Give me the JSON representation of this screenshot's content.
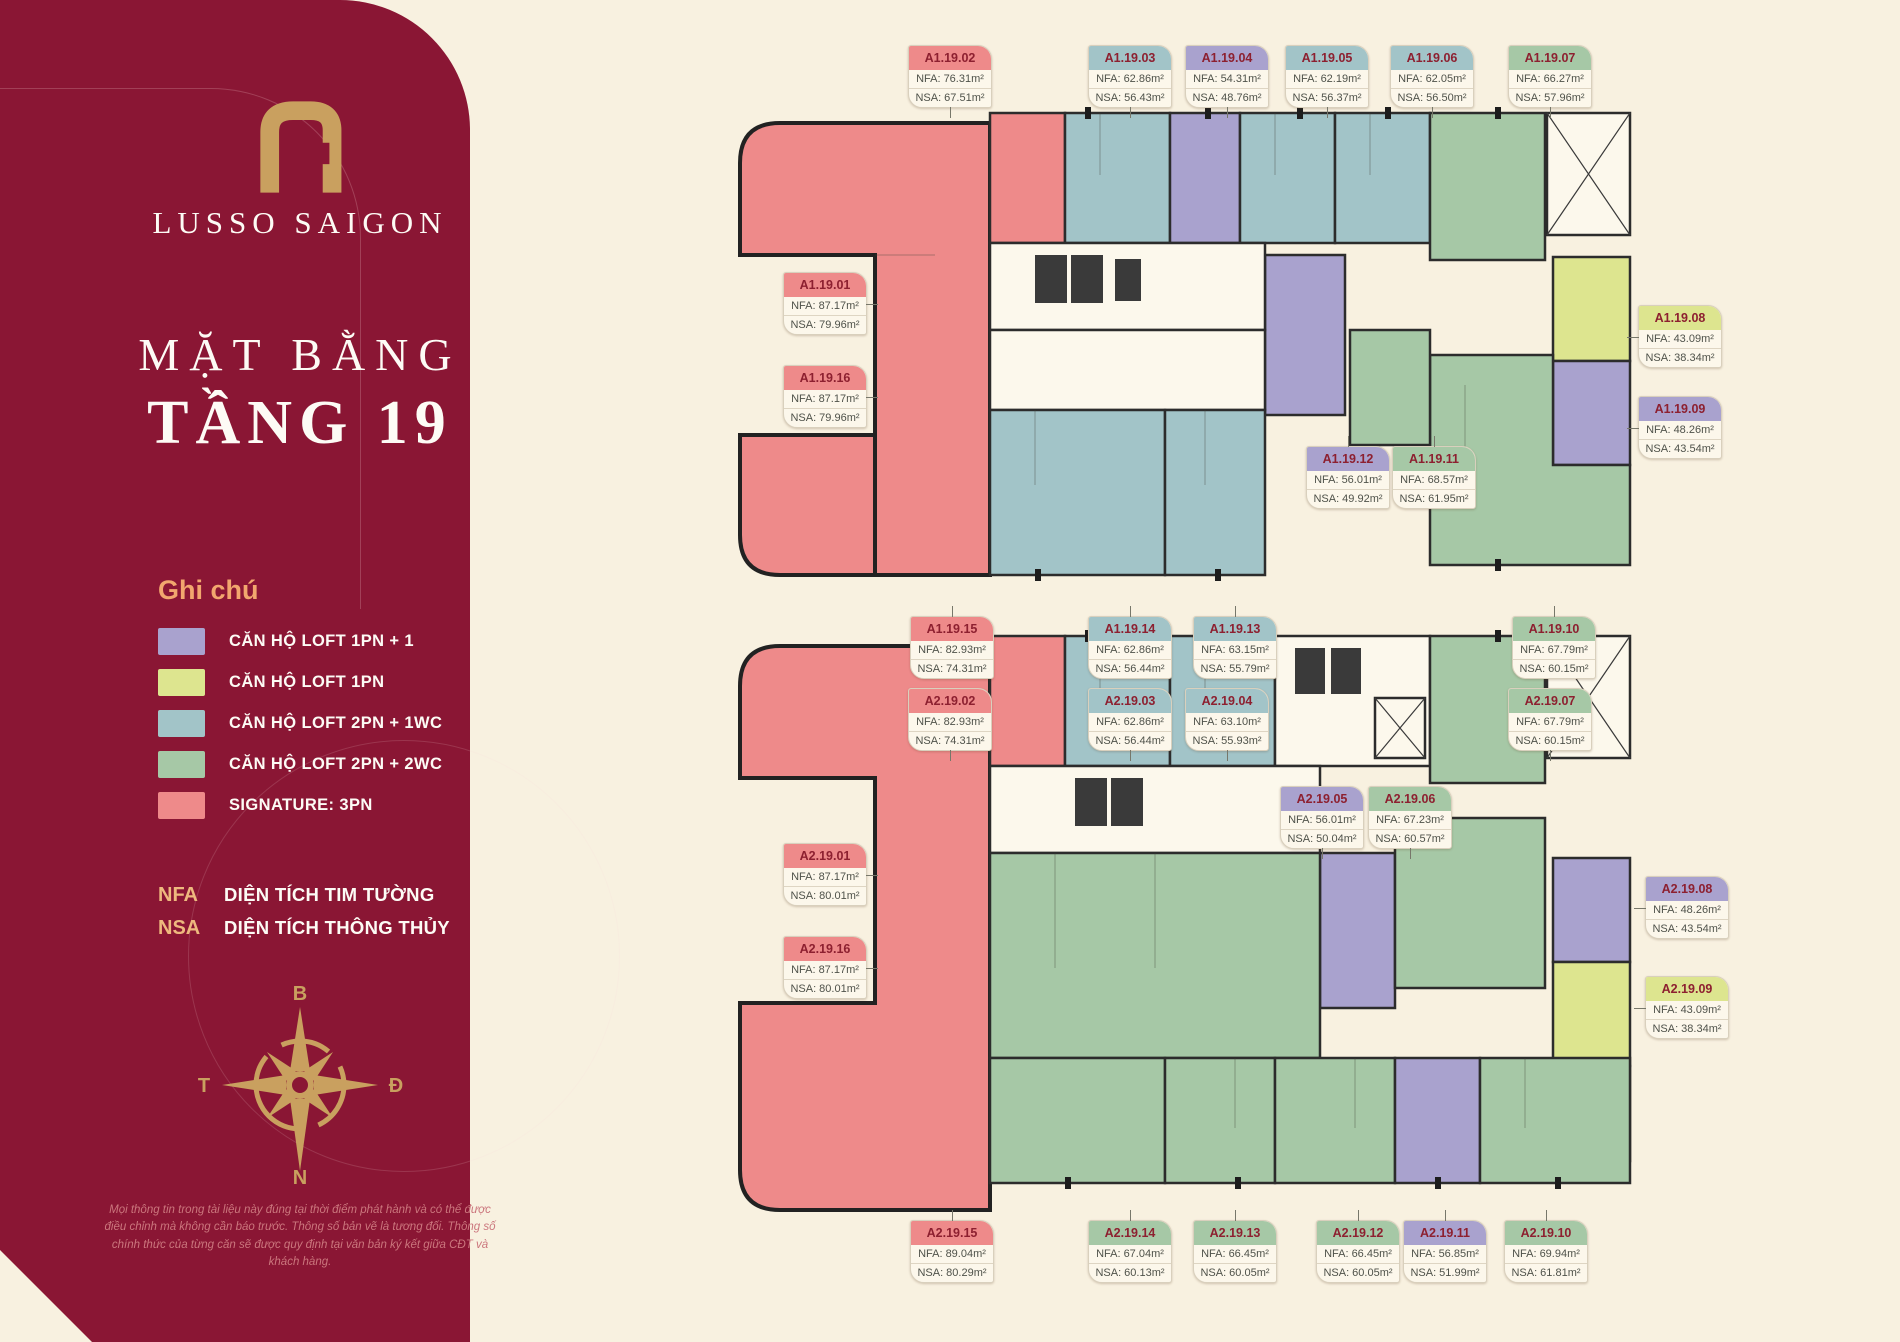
{
  "sidebar": {
    "brand": "LUSSO SAIGON",
    "title_line1": "MẶT BẰNG",
    "title_line2": "TẦNG 19",
    "legend_title": "Ghi chú",
    "legend": [
      {
        "label": "CĂN HỘ LOFT 1PN + 1",
        "color": "#a9a2ce"
      },
      {
        "label": "CĂN HỘ LOFT 1PN",
        "color": "#dde58f"
      },
      {
        "label": "CĂN HỘ LOFT 2PN + 1WC",
        "color": "#a2c4c8"
      },
      {
        "label": "CĂN HỘ LOFT 2PN + 2WC",
        "color": "#a6c8a6"
      },
      {
        "label": "SIGNATURE: 3PN",
        "color": "#ee8a8a"
      }
    ],
    "abbreviations": [
      {
        "key": "NFA",
        "label": "DIỆN TÍCH TIM TƯỜNG"
      },
      {
        "key": "NSA",
        "label": "DIỆN TÍCH THÔNG THỦY"
      }
    ],
    "compass": {
      "north": "B",
      "south": "N",
      "west": "T",
      "east": "Đ"
    },
    "disclaimer": "Mọi thông tin trong tài liệu này đúng tại thời điểm phát hành và có thể được điều chỉnh mà không cần báo trước. Thông số bản vẽ là tương đối. Thông số chính thức của từng căn sẽ được quy định tại văn bản ký kết giữa CĐT và khách hàng."
  },
  "card_keys": {
    "nfa_prefix": "NFA:",
    "nsa_prefix": "NSA:"
  },
  "colors": {
    "background": "#f8f1e0",
    "panel": "#8a1634",
    "gold": "#c9a05f",
    "legend_title": "#f2a76e",
    "card_header_text": "#8d2030",
    "signature": "#ee8a8a",
    "loft_1pn_1": "#a9a2ce",
    "loft_1pn": "#dde58f",
    "loft_2pn_1wc": "#a2c4c8",
    "loft_2pn_2wc": "#a6c8a6"
  },
  "units": [
    {
      "id": "A1.19.01",
      "nfa": "87.17m²",
      "nsa": "79.96m²",
      "type": "signature"
    },
    {
      "id": "A1.19.02",
      "nfa": "76.31m²",
      "nsa": "67.51m²",
      "type": "signature"
    },
    {
      "id": "A1.19.03",
      "nfa": "62.86m²",
      "nsa": "56.43m²",
      "type": "loft_2pn_1wc"
    },
    {
      "id": "A1.19.04",
      "nfa": "54.31m²",
      "nsa": "48.76m²",
      "type": "loft_1pn_1"
    },
    {
      "id": "A1.19.05",
      "nfa": "62.19m²",
      "nsa": "56.37m²",
      "type": "loft_2pn_1wc"
    },
    {
      "id": "A1.19.06",
      "nfa": "62.05m²",
      "nsa": "56.50m²",
      "type": "loft_2pn_1wc"
    },
    {
      "id": "A1.19.07",
      "nfa": "66.27m²",
      "nsa": "57.96m²",
      "type": "loft_2pn_2wc"
    },
    {
      "id": "A1.19.08",
      "nfa": "43.09m²",
      "nsa": "38.34m²",
      "type": "loft_1pn"
    },
    {
      "id": "A1.19.09",
      "nfa": "48.26m²",
      "nsa": "43.54m²",
      "type": "loft_1pn_1"
    },
    {
      "id": "A1.19.10",
      "nfa": "67.79m²",
      "nsa": "60.15m²",
      "type": "loft_2pn_2wc"
    },
    {
      "id": "A1.19.11",
      "nfa": "68.57m²",
      "nsa": "61.95m²",
      "type": "loft_2pn_2wc"
    },
    {
      "id": "A1.19.12",
      "nfa": "56.01m²",
      "nsa": "49.92m²",
      "type": "loft_1pn_1"
    },
    {
      "id": "A1.19.13",
      "nfa": "63.15m²",
      "nsa": "55.79m²",
      "type": "loft_2pn_1wc"
    },
    {
      "id": "A1.19.14",
      "nfa": "62.86m²",
      "nsa": "56.44m²",
      "type": "loft_2pn_1wc"
    },
    {
      "id": "A1.19.15",
      "nfa": "82.93m²",
      "nsa": "74.31m²",
      "type": "signature"
    },
    {
      "id": "A1.19.16",
      "nfa": "87.17m²",
      "nsa": "79.96m²",
      "type": "signature"
    },
    {
      "id": "A2.19.01",
      "nfa": "87.17m²",
      "nsa": "80.01m²",
      "type": "signature"
    },
    {
      "id": "A2.19.02",
      "nfa": "82.93m²",
      "nsa": "74.31m²",
      "type": "signature"
    },
    {
      "id": "A2.19.03",
      "nfa": "62.86m²",
      "nsa": "56.44m²",
      "type": "loft_2pn_1wc"
    },
    {
      "id": "A2.19.04",
      "nfa": "63.10m²",
      "nsa": "55.93m²",
      "type": "loft_2pn_1wc"
    },
    {
      "id": "A2.19.05",
      "nfa": "56.01m²",
      "nsa": "50.04m²",
      "type": "loft_1pn_1"
    },
    {
      "id": "A2.19.06",
      "nfa": "67.23m²",
      "nsa": "60.57m²",
      "type": "loft_2pn_2wc"
    },
    {
      "id": "A2.19.07",
      "nfa": "67.79m²",
      "nsa": "60.15m²",
      "type": "loft_2pn_2wc"
    },
    {
      "id": "A2.19.08",
      "nfa": "48.26m²",
      "nsa": "43.54m²",
      "type": "loft_1pn_1"
    },
    {
      "id": "A2.19.09",
      "nfa": "43.09m²",
      "nsa": "38.34m²",
      "type": "loft_1pn"
    },
    {
      "id": "A2.19.10",
      "nfa": "69.94m²",
      "nsa": "61.81m²",
      "type": "loft_2pn_2wc"
    },
    {
      "id": "A2.19.11",
      "nfa": "56.85m²",
      "nsa": "51.99m²",
      "type": "loft_1pn_1"
    },
    {
      "id": "A2.19.12",
      "nfa": "66.45m²",
      "nsa": "60.05m²",
      "type": "loft_2pn_2wc"
    },
    {
      "id": "A2.19.13",
      "nfa": "66.45m²",
      "nsa": "60.05m²",
      "type": "loft_2pn_2wc"
    },
    {
      "id": "A2.19.14",
      "nfa": "67.04m²",
      "nsa": "60.13m²",
      "type": "loft_2pn_2wc"
    },
    {
      "id": "A2.19.15",
      "nfa": "89.04m²",
      "nsa": "80.29m²",
      "type": "signature"
    },
    {
      "id": "A2.19.16",
      "nfa": "87.17m²",
      "nsa": "80.01m²",
      "type": "signature"
    }
  ]
}
